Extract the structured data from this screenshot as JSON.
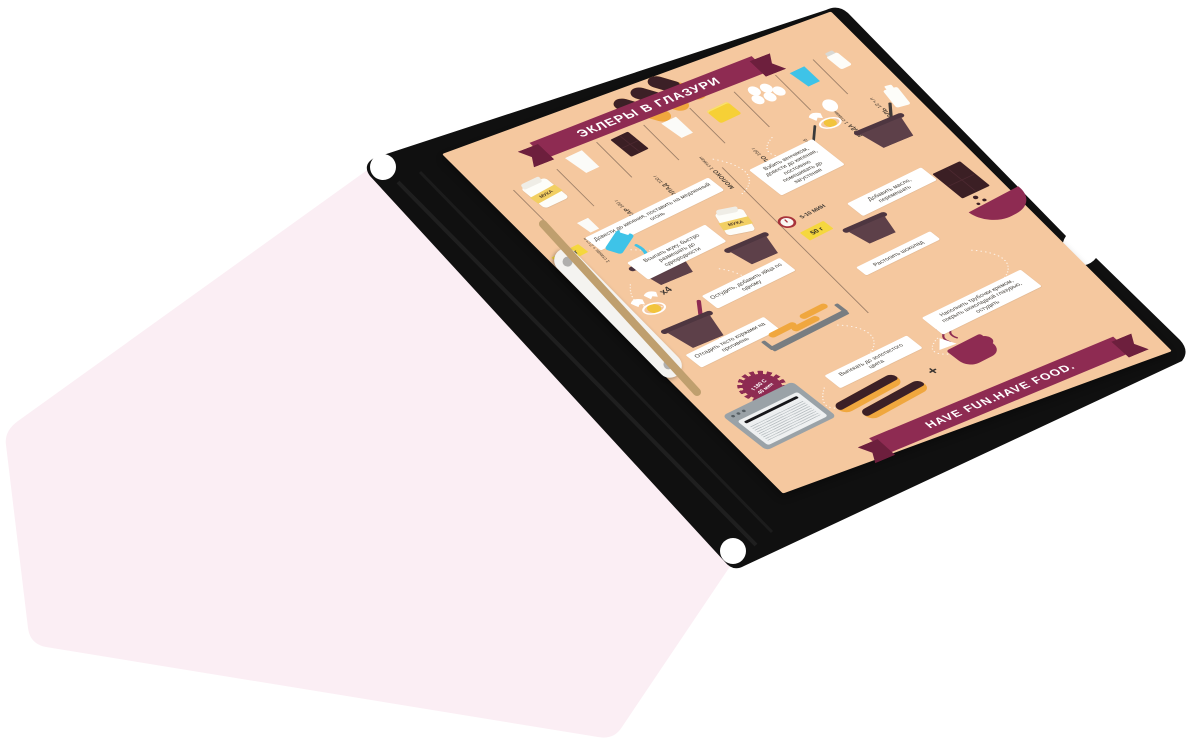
{
  "poster": {
    "title": "ЭКЛЕРЫ В ГЛАЗУРИ",
    "footer": "HAVE FUN.HAVE FOOD.",
    "bag_label": "МУКА",
    "ingredients": [
      {
        "name": "МУКА",
        "amount": "1 стакан + 2 ст.л"
      },
      {
        "name": "САХАР",
        "amount": "100 г"
      },
      {
        "name": "ШОКОЛАД",
        "amount": "100 г"
      },
      {
        "name": "МОЛОКО",
        "amount": "1 стакан"
      },
      {
        "name": "МАСЛО",
        "amount": "150 г"
      },
      {
        "name": "ЯЙЦА",
        "amount": "х5"
      },
      {
        "name": "ВОДА",
        "amount": "1 стакан"
      },
      {
        "name": "СОЛЬ",
        "amount": "1/2 ч.л"
      }
    ],
    "steps_left": [
      "Довести до кипения, поставить на медленный огонь",
      "Всыпать муку, быстро размешать до однородности",
      "Остудить, добавить яйца по одному",
      "Отсадить тесто коржами на противень",
      "Выпекать до золотистого цвета"
    ],
    "steps_right": [
      "Взбить венчиком, довести до кипения, постоянно помешивать до загустения",
      "Добавить масло, перемешать",
      "Растопить шоколад",
      "Наполнить трубочки кремом, покрыть шоколадной глазурью, остудить"
    ],
    "labels": {
      "x4": "х4",
      "butter_weight": "150 г",
      "flour_weight": "50 г",
      "simmer_time": "5-10 МИН",
      "bake_temp": "t 180 C",
      "bake_time": "40 мин",
      "plus": "+"
    },
    "icons": {
      "flour-bag-icon": "paper flour bag",
      "sugar-cup-icon": "measuring cup",
      "chocolate-bar-icon": "chocolate bar",
      "milk-glass-icon": "glass of milk",
      "butter-icon": "butter block",
      "eggs-icon": "five eggs",
      "water-glass-icon": "glass of water",
      "salt-shaker-icon": "salt shaker",
      "pot-icon": "saucepan",
      "whisk-icon": "whisk",
      "clock-icon": "timer clock",
      "oven-icon": "oven",
      "tray-icon": "baking tray",
      "bowl-icon": "glaze bowl",
      "cup-icon": "coffee mug",
      "eclair-icon": "glazed eclair"
    },
    "colors": {
      "page_peach": "#f5c89f",
      "accent_magenta": "#8e2b52",
      "chocolate": "#3b1f24",
      "pot_plum": "#5d4049",
      "dough_orange": "#f0a73e",
      "tag_yellow": "#f5d73e",
      "water_cyan": "#3ec3e8",
      "folder_black": "#101010",
      "sheet_pink": "#fbeef4"
    }
  }
}
